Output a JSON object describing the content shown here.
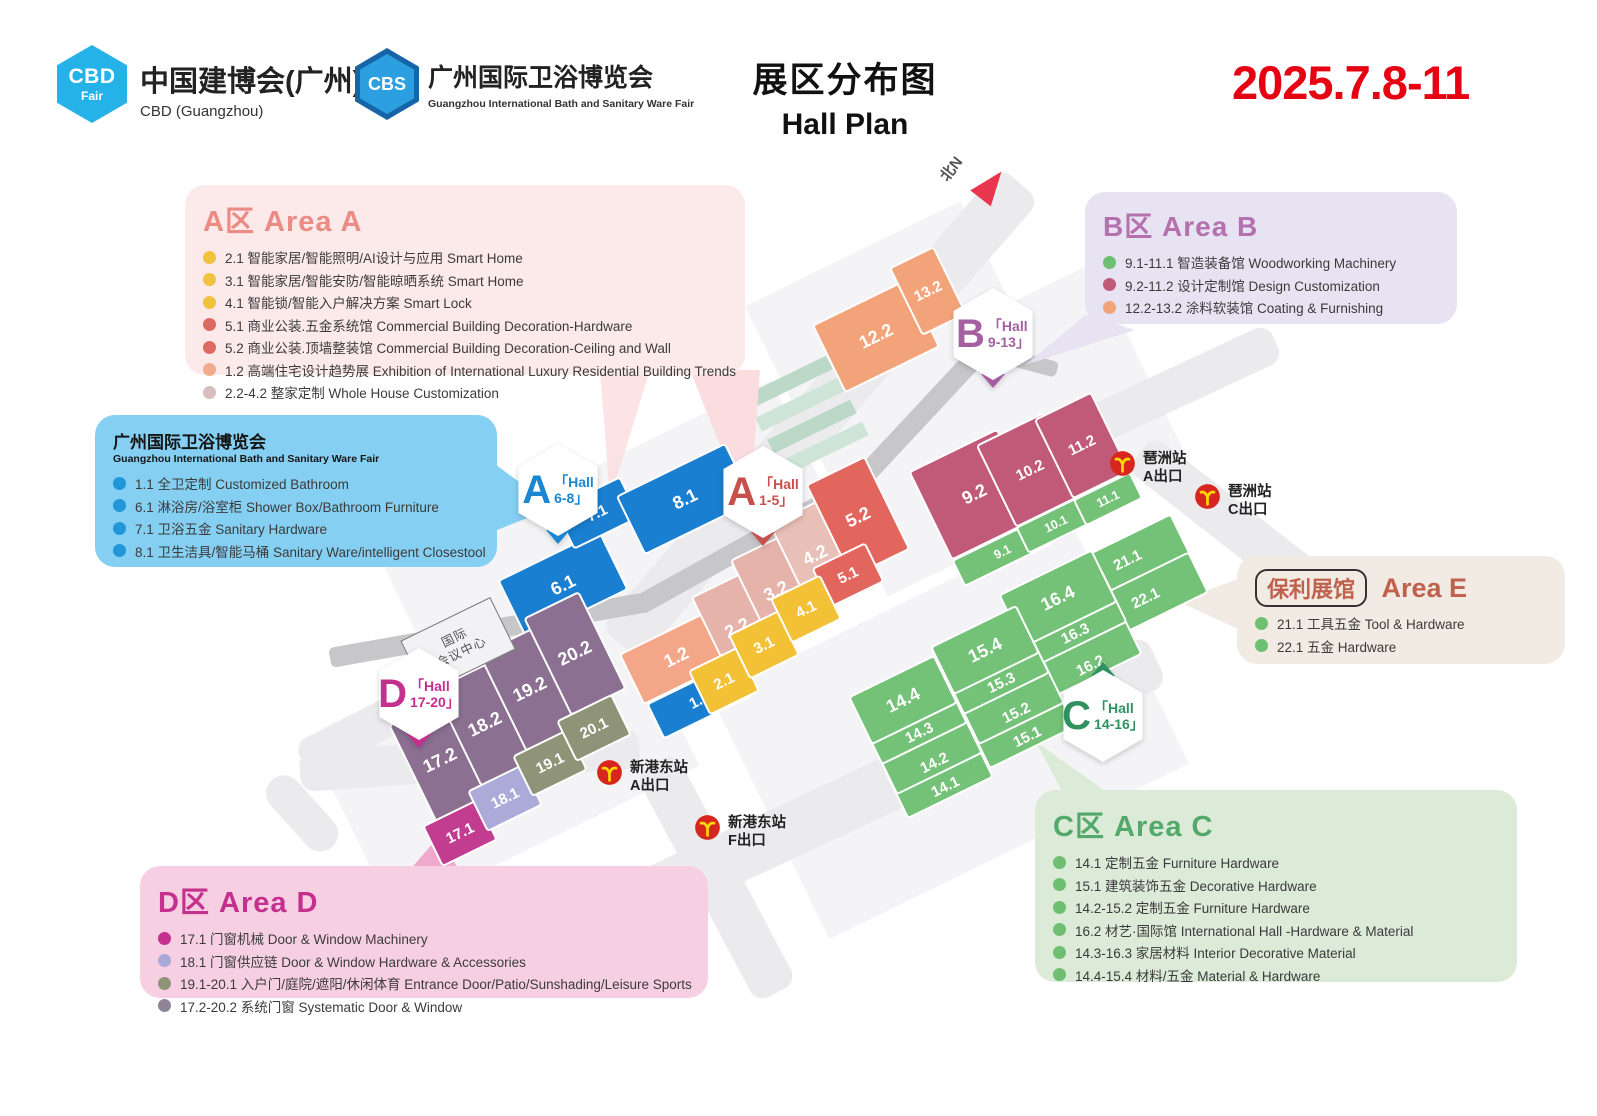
{
  "header": {
    "cbd_logo_abbr": "CBD",
    "cbd_logo_sub": "Fair",
    "cbd_name_cn": "中国建博会(广州)",
    "cbd_name_en": "CBD (Guangzhou)",
    "cbs_logo_abbr": "CBS",
    "cbs_name_cn": "广州国际卫浴博览会",
    "cbs_name_en": "Guangzhou International Bath and Sanitary Ware Fair",
    "title_cn": "展区分布图",
    "title_en": "Hall Plan",
    "dates": "2025.7.8-11"
  },
  "map": {
    "north_label": "北N",
    "convention_center_line1": "国际",
    "convention_center_line2": "会议中心",
    "badges": [
      {
        "letter": "A",
        "line1": "「Hall",
        "line2": "6-8」",
        "color": "#1b87d2"
      },
      {
        "letter": "A",
        "line1": "「Hall",
        "line2": "1-5」",
        "color": "#c8504c"
      },
      {
        "letter": "B",
        "line1": "「Hall",
        "line2": "9-13」",
        "color": "#a45fa0"
      },
      {
        "letter": "C",
        "line1": "「Hall",
        "line2": "14-16」",
        "color": "#2f9160"
      },
      {
        "letter": "D",
        "line1": "「Hall",
        "line2": "17-20」",
        "color": "#c4308e"
      }
    ],
    "stations": [
      {
        "name": "琶洲站",
        "exit": "A出口"
      },
      {
        "name": "琶洲站",
        "exit": "C出口"
      },
      {
        "name": "新港东站",
        "exit": "A出口"
      },
      {
        "name": "新港东站",
        "exit": "F出口"
      }
    ],
    "halls": [
      {
        "label": "6.1"
      },
      {
        "label": "7.1"
      },
      {
        "label": "8.1"
      },
      {
        "label": "1.1"
      },
      {
        "label": "1.2"
      },
      {
        "label": "2.2"
      },
      {
        "label": "3.2"
      },
      {
        "label": "4.2"
      },
      {
        "label": "5.2"
      },
      {
        "label": "5.1"
      },
      {
        "label": "2.1"
      },
      {
        "label": "3.1"
      },
      {
        "label": "4.1"
      },
      {
        "label": "12.2"
      },
      {
        "label": "13.2"
      },
      {
        "label": "9.2"
      },
      {
        "label": "10.2"
      },
      {
        "label": "11.2"
      },
      {
        "label": "9.1"
      },
      {
        "label": "10.1"
      },
      {
        "label": "11.1"
      },
      {
        "label": "16.4"
      },
      {
        "label": "16.3"
      },
      {
        "label": "16.2"
      },
      {
        "label": "15.4"
      },
      {
        "label": "15.3"
      },
      {
        "label": "15.2"
      },
      {
        "label": "15.1"
      },
      {
        "label": "14.4"
      },
      {
        "label": "14.3"
      },
      {
        "label": "14.2"
      },
      {
        "label": "14.1"
      },
      {
        "label": "21.1"
      },
      {
        "label": "22.1"
      },
      {
        "label": "17.2"
      },
      {
        "label": "18.2"
      },
      {
        "label": "19.2"
      },
      {
        "label": "20.2"
      },
      {
        "label": "17.1"
      },
      {
        "label": "18.1"
      },
      {
        "label": "19.1"
      },
      {
        "label": "20.1"
      }
    ]
  },
  "legends": [
    {
      "title_cn": "A区",
      "title_en": "Area A",
      "color": "#ec8b84",
      "items": [
        {
          "dot": "#f0c23d",
          "text": "2.1 智能家居/智能照明/AI设计与应用 Smart Home"
        },
        {
          "dot": "#f0c23d",
          "text": "3.1 智能家居/智能安防/智能晾晒系统 Smart Home"
        },
        {
          "dot": "#f0c23d",
          "text": "4.1 智能锁/智能入户解决方案 Smart Lock"
        },
        {
          "dot": "#dd6a62",
          "text": "5.1 商业公装.五金系统馆 Commercial Building Decoration-Hardware"
        },
        {
          "dot": "#dd6a62",
          "text": "5.2 商业公装.顶墙整装馆 Commercial Building Decoration-Ceiling and Wall"
        },
        {
          "dot": "#f2ab8d",
          "text": "1.2 高端住宅设计趋势展 Exhibition of International Luxury Residential Building Trends"
        },
        {
          "dot": "#d9bdbd",
          "text": "2.2-4.2 整家定制 Whole House Customization"
        }
      ]
    },
    {
      "title_cn": "广州国际卫浴博览会",
      "title_en": "Guangzhou International Bath and Sanitary Ware Fair",
      "items": [
        {
          "dot": "#2196d8",
          "text": "1.1 全卫定制 Customized Bathroom"
        },
        {
          "dot": "#2196d8",
          "text": "6.1 淋浴房/浴室柜 Shower Box/Bathroom Furniture"
        },
        {
          "dot": "#2196d8",
          "text": "7.1 卫浴五金 Sanitary Hardware"
        },
        {
          "dot": "#2196d8",
          "text": "8.1 卫生洁具/智能马桶 Sanitary Ware/intelligent Closestool"
        }
      ]
    },
    {
      "title_cn": "B区",
      "title_en": "Area B",
      "color": "#b570ae",
      "items": [
        {
          "dot": "#6fbf73",
          "text": "9.1-11.1 智造装备馆 Woodworking Machinery"
        },
        {
          "dot": "#c05a78",
          "text": "9.2-11.2 设计定制馆 Design Customization"
        },
        {
          "dot": "#f2a379",
          "text": "12.2-13.2 涂料软装馆 Coating & Furnishing"
        }
      ]
    },
    {
      "badge": "保利展馆",
      "title_en": "Area E",
      "color": "#c0614e",
      "items": [
        {
          "dot": "#6fbf73",
          "text": "21.1 工具五金 Tool & Hardware"
        },
        {
          "dot": "#6fbf73",
          "text": "22.1 五金 Hardware"
        }
      ]
    },
    {
      "title_cn": "C区",
      "title_en": "Area C",
      "color": "#53a86b",
      "items": [
        {
          "dot": "#6fbf73",
          "text": "14.1 定制五金 Furniture Hardware"
        },
        {
          "dot": "#6fbf73",
          "text": "15.1 建筑装饰五金 Decorative Hardware"
        },
        {
          "dot": "#6fbf73",
          "text": "14.2-15.2 定制五金 Furniture Hardware"
        },
        {
          "dot": "#6fbf73",
          "text": "16.2 材艺·国际馆 International Hall -Hardware & Material"
        },
        {
          "dot": "#6fbf73",
          "text": "14.3-16.3 家居材料 Interior Decorative Material"
        },
        {
          "dot": "#6fbf73",
          "text": "14.4-15.4 材料/五金 Material & Hardware"
        }
      ]
    },
    {
      "title_cn": "D区",
      "title_en": "Area D",
      "color": "#c4308e",
      "items": [
        {
          "dot": "#c4308e",
          "text": "17.1 门窗机械  Door & Window Machinery"
        },
        {
          "dot": "#a9a9d8",
          "text": "18.1 门窗供应链  Door & Window Hardware & Accessories"
        },
        {
          "dot": "#8f9377",
          "text": "19.1-20.1 入户门/庭院/遮阳/休闲体育 Entrance Door/Patio/Sunshading/Leisure Sports"
        },
        {
          "dot": "#8f8496",
          "text": "17.2-20.2 系统门窗 Systematic Door & Window"
        }
      ]
    }
  ],
  "colors": {
    "date_red": "#e60113",
    "hall_blue": "#1a7fd1",
    "hall_peach": "#f4a688",
    "hall_beige": "#e5b3aa",
    "hall_yellow": "#f3c136",
    "hall_red": "#e2655e",
    "hall_orange": "#f2a379",
    "hall_dark_pink": "#c05a78",
    "hall_green": "#74c178",
    "hall_purple": "#8b7092",
    "hall_magenta": "#c23c8f",
    "hall_periwinkle": "#abaad8",
    "hall_olive": "#8f9377",
    "metro_red": "#d7261d",
    "metro_yellow": "#ffd800"
  }
}
